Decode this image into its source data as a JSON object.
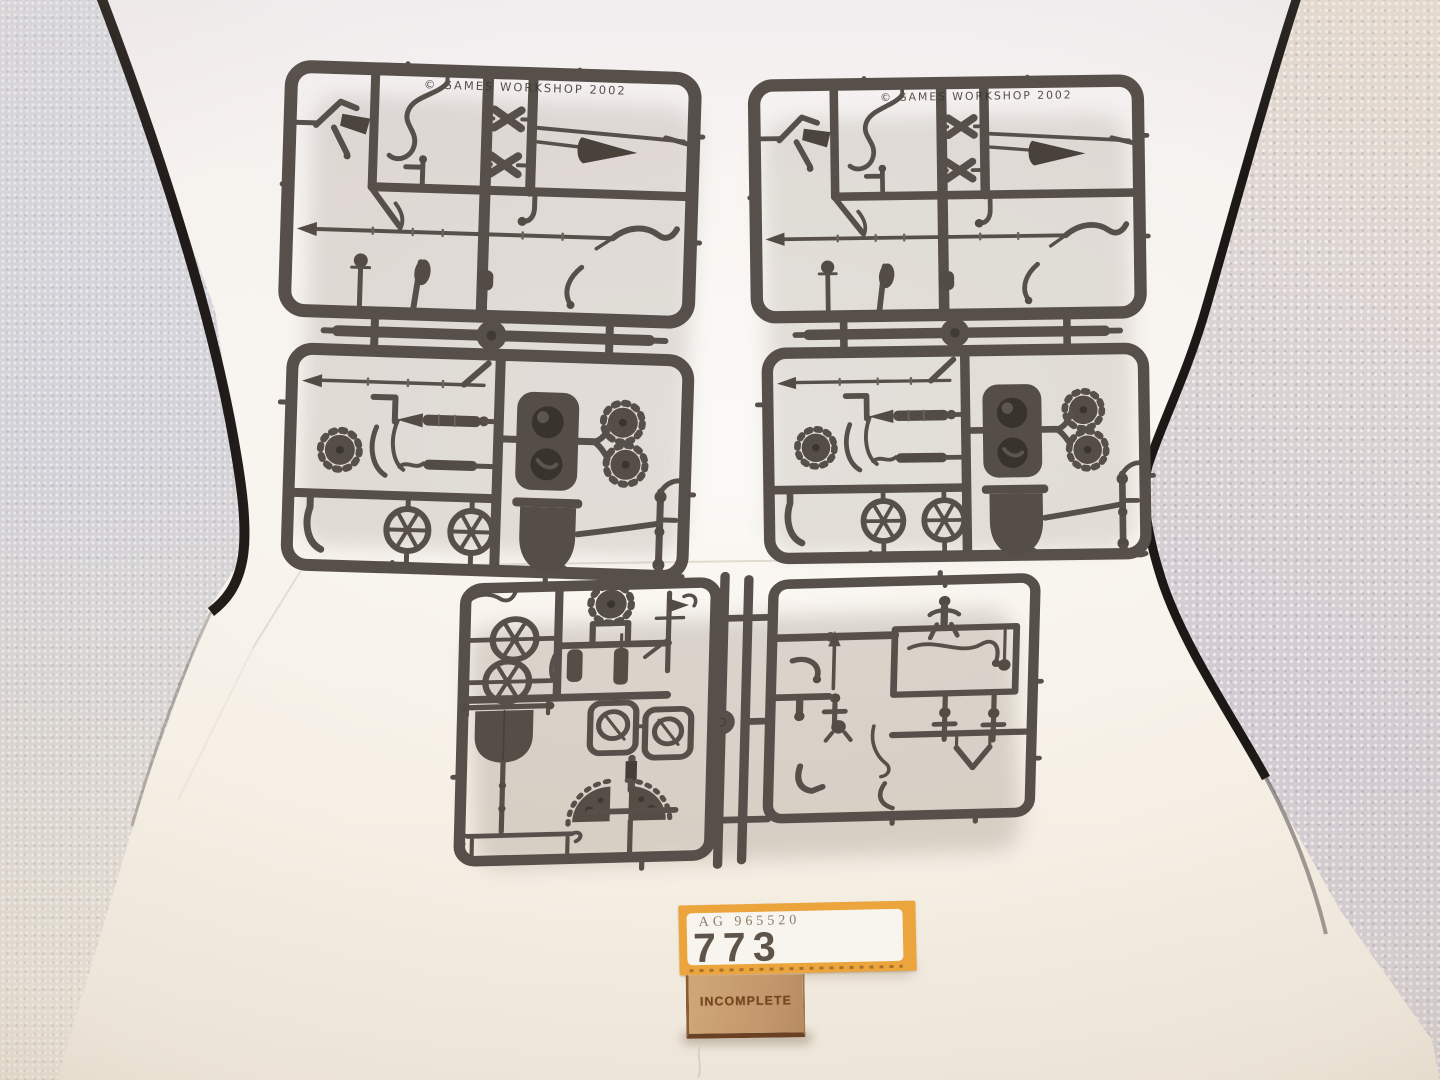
{
  "scene": {
    "type": "product-photo",
    "subject": "Four dark grey plastic model sprues (chariot kit) photographed inside a white light tent",
    "sprues": [
      {
        "id": "top-left",
        "name": "chariot sprue upper left",
        "embossed_text": "© GAMES WORKSHOP 2002"
      },
      {
        "id": "top-right",
        "name": "chariot sprue upper right",
        "embossed_text": "© GAMES WORKSHOP 2002"
      },
      {
        "id": "bottom-left",
        "name": "chariot sprue lower left",
        "embossed_text": ""
      },
      {
        "id": "bottom-right",
        "name": "chariot sprue lower right",
        "embossed_text": ""
      }
    ],
    "colors": {
      "sprue": "#57504a",
      "sprue_dark": "#3b352f",
      "backdrop": "#f5f1ea",
      "wall_grey": "#d2d1d6",
      "wall_cream": "#efe8dc",
      "tent_edge": "#15100d"
    }
  },
  "label": {
    "code": "AG 965520",
    "number": "773",
    "border_color": "#eca43d",
    "panel_color": "#f8f5ee",
    "code_color": "#8c7d6b",
    "number_color": "#5f5449"
  },
  "tag": {
    "text": "INCOMPLETE",
    "wood_color": "#c79d70",
    "engraving_color": "#74451f"
  }
}
